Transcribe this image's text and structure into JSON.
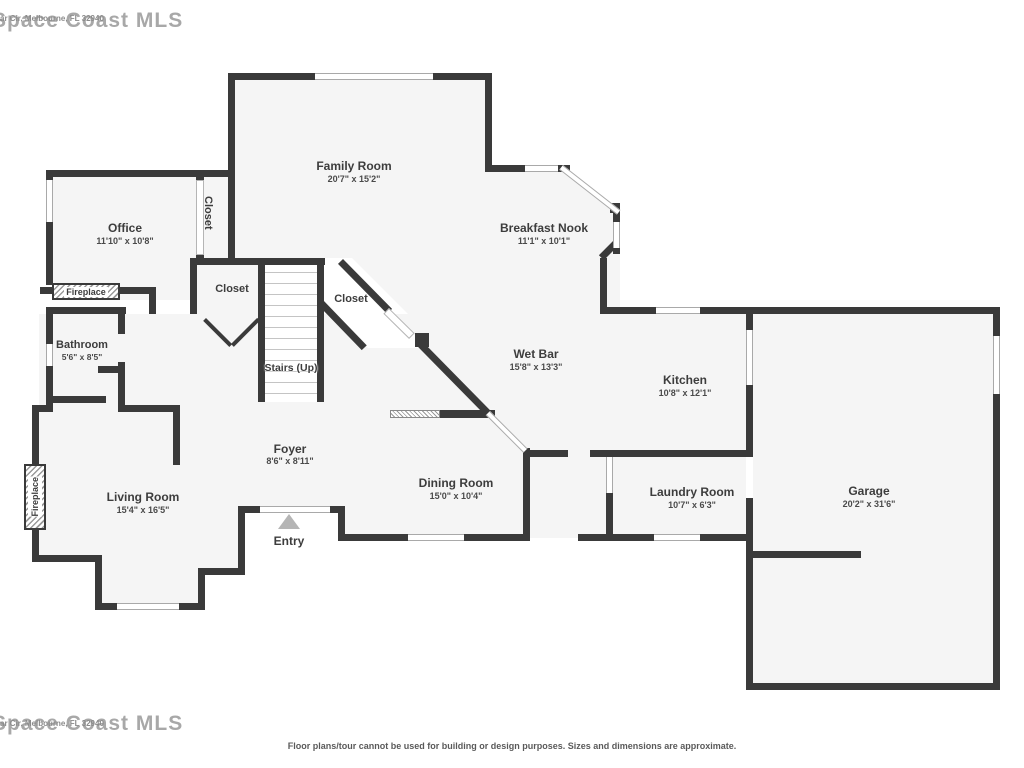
{
  "plan": {
    "rooms": [
      {
        "name": "Family Room",
        "dims": "20'7\" x 15'2\""
      },
      {
        "name": "Breakfast Nook",
        "dims": "11'1\" x 10'1\""
      },
      {
        "name": "Office",
        "dims": "11'10\" x 10'8\""
      },
      {
        "name": "Wet Bar",
        "dims": "15'8\" x 13'3\""
      },
      {
        "name": "Kitchen",
        "dims": "10'8\" x 12'1\""
      },
      {
        "name": "Bathroom",
        "dims": "5'6\" x 8'5\""
      },
      {
        "name": "Living Room",
        "dims": "15'4\" x 16'5\""
      },
      {
        "name": "Foyer",
        "dims": "8'6\" x 8'11\""
      },
      {
        "name": "Dining Room",
        "dims": "15'0\" x 10'4\""
      },
      {
        "name": "Laundry Room",
        "dims": "10'7\" x 6'3\""
      },
      {
        "name": "Garage",
        "dims": "20'2\" x 31'6\""
      }
    ],
    "closet_label": "Closet",
    "stairs_label": "Stairs (Up)",
    "fireplace_label": "Fireplace",
    "entry_label": "Entry"
  },
  "watermark": {
    "large": "Space Coast MLS",
    "small": "ar Cir, Melbourne, FL 32940"
  },
  "footer": {
    "disclaimer": "Floor plans/tour cannot be used for building or design purposes. Sizes and dimensions are approximate."
  },
  "colors": {
    "wall": "#3a3a3a",
    "floor": "#f5f5f5",
    "text": "#3d3d3d",
    "watermark": "#a8a8a8"
  }
}
